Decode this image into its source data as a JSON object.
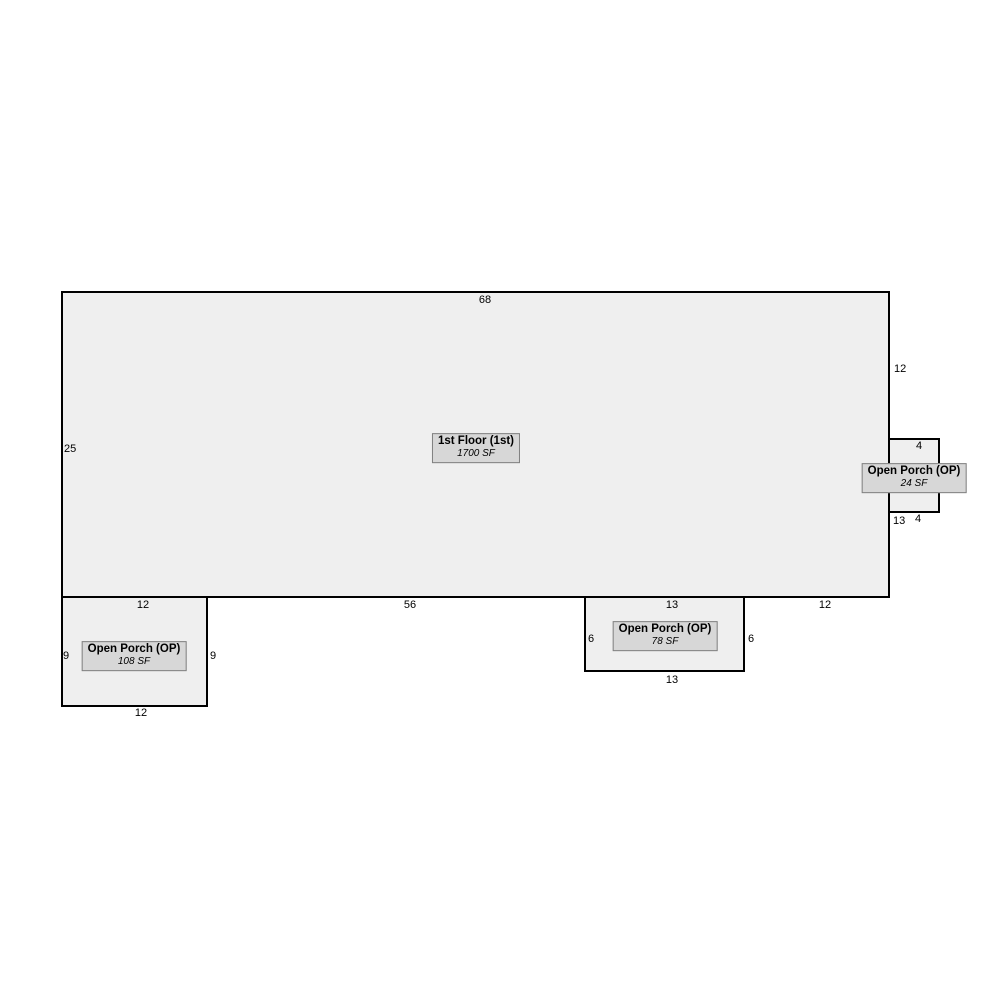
{
  "sketch": {
    "colors": {
      "background": "#ffffff",
      "area_fill": "#efefef",
      "outline": "#000000",
      "label_fill": "#d7d7d7",
      "label_border": "#808080",
      "text": "#000000"
    },
    "areas": {
      "first_floor": {
        "label": "1st Floor (1st)",
        "sf": "1700 SF"
      },
      "open_porch_right": {
        "label": "Open Porch (OP)",
        "sf": "24 SF"
      },
      "open_porch_left": {
        "label": "Open Porch (OP)",
        "sf": "108 SF"
      },
      "open_porch_middle": {
        "label": "Open Porch (OP)",
        "sf": "78 SF"
      }
    },
    "dimensions": {
      "first_floor_top": "68",
      "first_floor_left": "25",
      "first_floor_right_upper": "12",
      "first_floor_right_lower": "13",
      "first_floor_bottom_left": "12",
      "first_floor_bottom_middle": "56",
      "first_floor_bottom_porch": "13",
      "first_floor_bottom_right": "12",
      "open_porch_right_top": "4",
      "open_porch_right_bottom": "4",
      "open_porch_left_west": "9",
      "open_porch_left_east": "9",
      "open_porch_left_bottom": "12",
      "open_porch_middle_west": "6",
      "open_porch_middle_east": "6",
      "open_porch_middle_bottom": "13"
    }
  }
}
